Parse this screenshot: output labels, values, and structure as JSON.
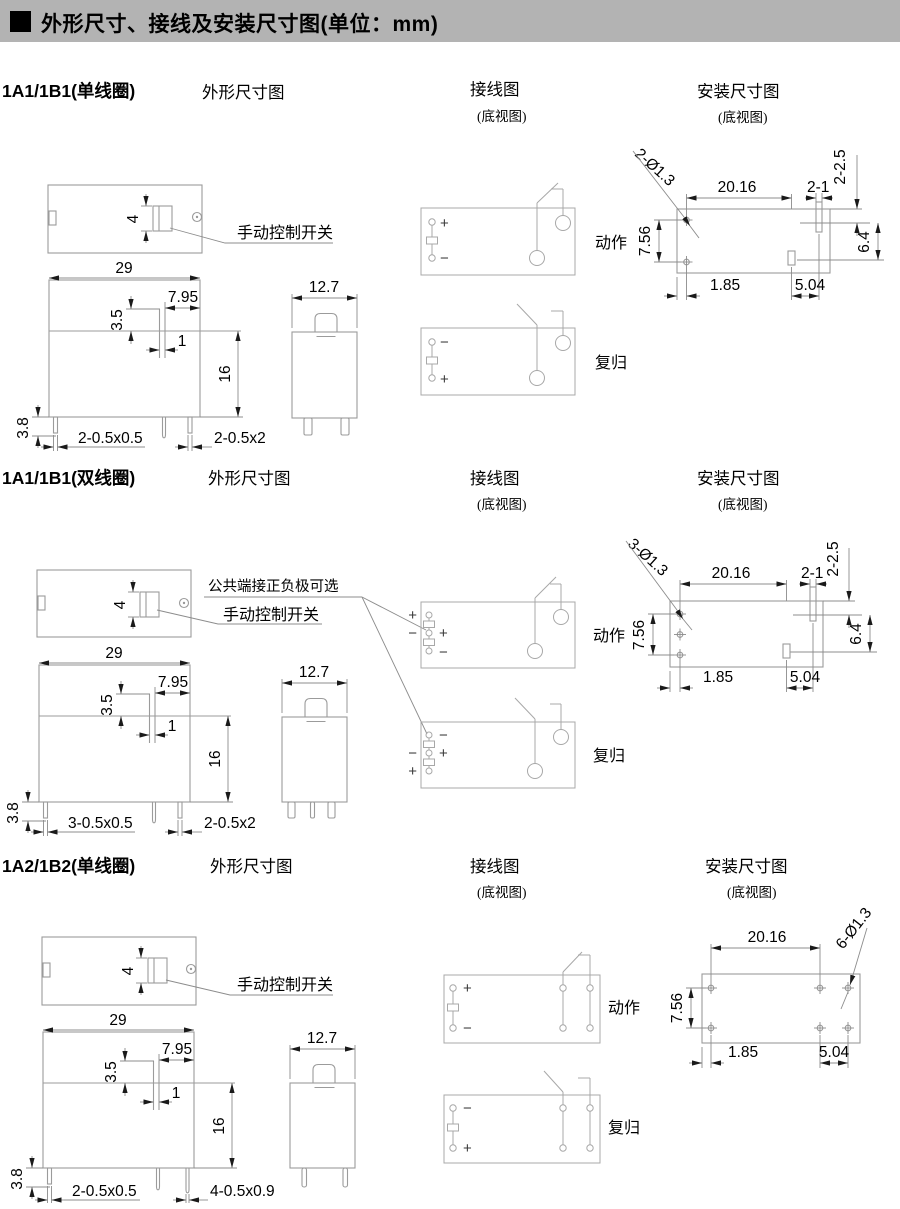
{
  "header": {
    "title": "外形尺寸、接线及安装尺寸图(单位：mm)"
  },
  "columns": {
    "outline": "外形尺寸图",
    "wiring": "接线图",
    "mount": "安装尺寸图",
    "bottom_view": "(底视图)"
  },
  "labels": {
    "manual_switch": "手动控制开关",
    "polarity_note": "公共端接正负极可选",
    "action": "动作",
    "reset": "复归",
    "plus": "+",
    "minus": "−"
  },
  "sections": [
    {
      "model": "1A1/1B1(单线圈)",
      "dims": {
        "switch_h": "4",
        "width": "29",
        "right_offset": "7.95",
        "notch": "3.5",
        "slot": "1",
        "height": "16",
        "pin_len": "3.8",
        "pins_left": "2-0.5x0.5",
        "pins_right": "2-0.5x2",
        "side_width": "12.7"
      },
      "mount": {
        "holes": "2-Ø1.3",
        "pitch_x": "20.16",
        "slot_w": "2-1",
        "slot_len": "2-2.5",
        "offset": "6.4",
        "pitch_y": "7.56",
        "edge_l": "1.85",
        "edge_r": "5.04"
      }
    },
    {
      "model": "1A1/1B1(双线圈)",
      "dims": {
        "switch_h": "4",
        "width": "29",
        "right_offset": "7.95",
        "notch": "3.5",
        "slot": "1",
        "height": "16",
        "pin_len": "3.8",
        "pins_left": "3-0.5x0.5",
        "pins_right": "2-0.5x2",
        "side_width": "12.7"
      },
      "mount": {
        "holes": "3-Ø1.3",
        "pitch_x": "20.16",
        "slot_w": "2-1",
        "slot_len": "2-2.5",
        "offset": "6.4",
        "pitch_y": "7.56",
        "edge_l": "1.85",
        "edge_r": "5.04"
      }
    },
    {
      "model": "1A2/1B2(单线圈)",
      "dims": {
        "switch_h": "4",
        "width": "29",
        "right_offset": "7.95",
        "notch": "3.5",
        "slot": "1",
        "height": "16",
        "pin_len": "3.8",
        "pins_left": "2-0.5x0.5",
        "pins_right": "4-0.5x0.9",
        "side_width": "12.7"
      },
      "mount": {
        "holes": "6-Ø1.3",
        "pitch_x": "20.16",
        "pitch_y": "7.56",
        "edge_l": "1.85",
        "edge_r": "5.04"
      }
    }
  ]
}
